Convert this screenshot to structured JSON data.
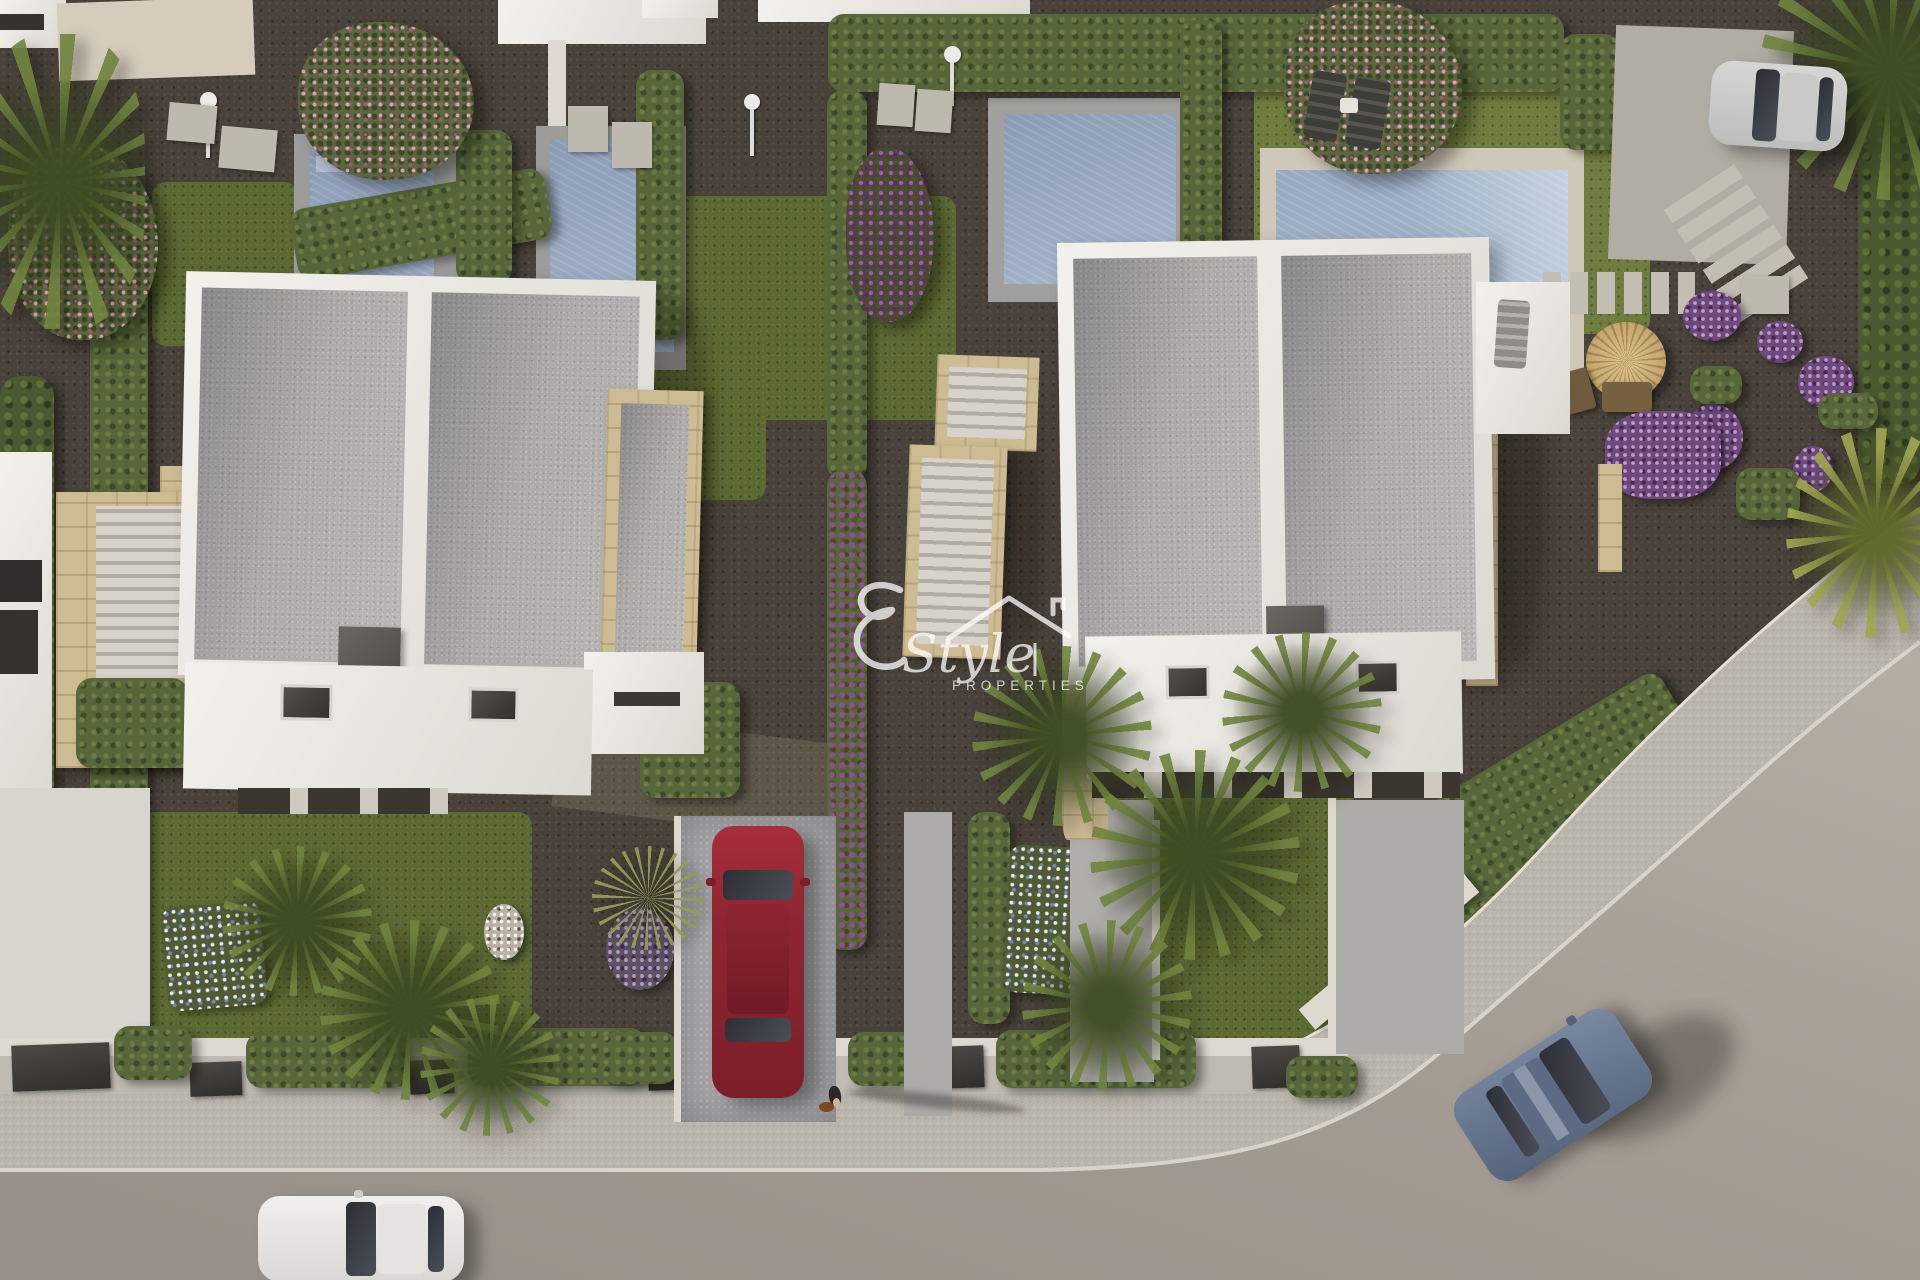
{
  "meta": {
    "description": "Aerial top-down 3D architectural render of a modern white-villa residential development at golden hour, with private pools, gravel gardens, palm trees, a curved street and parked cars",
    "image_kind": "3d-render",
    "view": "top-down aerial"
  },
  "watermark": {
    "brand": "Style",
    "subtitle": "PROPERTIES",
    "icon": "house-roof-outline",
    "color": "#ffffff",
    "opacity": 0.74
  },
  "palette": {
    "gravel_dark": "#49423a",
    "roof_gravel": "#b6b4b1",
    "villa_white": "#f0eee9",
    "stone_beige": "#cdbb92",
    "lawn_green": "#5c6a32",
    "hedge_green": "#57673a",
    "cypress_green": "#4a5a30",
    "pool_water": "#8e9eb7",
    "pool_coping_grey": "#9c9c9a",
    "pool_coping_cream": "#cfc8b8",
    "road_grey": "#a39c93",
    "sidewalk_grey": "#bab5ac",
    "curb_white": "#d8d4cc",
    "car_red": "#8f2532",
    "car_white": "#eceae7",
    "car_blue": "#64748c",
    "car_silver": "#cfcfcd",
    "flowers_purple": "#8a4f97",
    "flowers_pink": "#d8a8b6",
    "flowers_blue_white": "#a9b6d6",
    "parasol_straw": "#c9aa70"
  },
  "inventory": {
    "villas": [
      "left detached villa: white parapet flat roof in two gravel sections, sandstone-clad side terrace, lower white roof with two skylights",
      "right detached villa: white parapet flat roof in two gravel sections, sandstone trims, lower white roof with two skylights and entry pergola"
    ],
    "pools": [
      "top-left garden pool with grey surround",
      "second top garden pool with grey surround",
      "central garden pool with grey surround",
      "top-right pool with cream deck, two sun loungers and side table"
    ],
    "vehicles": [
      "dark-red hatchback parked on centre driveway",
      "white car parked on the bottom road",
      "slate-blue car driving on the curved road, bottom right",
      "silver car parked on the top-right drive"
    ],
    "figures": [
      "pedestrian in dark top walking a small brown dog on the sidewalk, long shadow to the right"
    ],
    "garden_features": [
      "clipped hedges and cypress screens",
      "pink flowering trees",
      "purple bougainvillea hedge",
      "blue-and-white flower beds",
      "fan palm clusters",
      "yucca",
      "ornamental white and purple ball shrubs",
      "straw garden parasol with wooden chairs",
      "stepping-stone paths",
      "outdoor showers",
      "white boundary walls with dark gates",
      "curved street with sidewalk and white curb"
    ]
  }
}
